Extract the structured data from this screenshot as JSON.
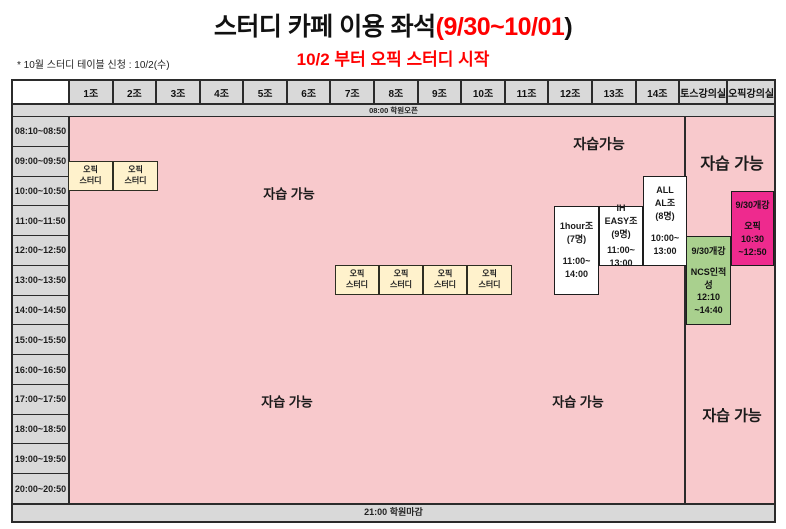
{
  "title": {
    "main": "스터디 카페 이용 좌석",
    "dates": "(9/30~10/01",
    "close_paren": ")",
    "subtitle": "10/2 부터 오픽 스터디 시작"
  },
  "note": "* 10월 스터디 테이블 신청 : 10/2(수)",
  "banners": {
    "open": "08:00 학원오픈",
    "close": "21:00 학원마감"
  },
  "columns": [
    "1조",
    "2조",
    "3조",
    "4조",
    "5조",
    "6조",
    "7조",
    "8조",
    "9조",
    "10조",
    "11조",
    "12조",
    "13조",
    "14조",
    "토스강의실",
    "오픽강의실"
  ],
  "times": [
    "08:10~08:50",
    "09:00~09:50",
    "10:00~10:50",
    "11:00~11:50",
    "12:00~12:50",
    "13:00~13:50",
    "14:00~14:50",
    "15:00~15:50",
    "16:00~16:50",
    "17:00~17:50",
    "18:00~18:50",
    "19:00~19:50",
    "20:00~20:50"
  ],
  "free_study": {
    "main_top": "자습 가능",
    "mid_top": "자습가능",
    "lecture_top": "자습 가능",
    "main_bottom": "자습 가능",
    "mid_bottom": "자습 가능",
    "lecture_bottom": "자습 가능"
  },
  "study_cells": {
    "opic_line1": "오픽",
    "opic_line2": "스터디"
  },
  "group_cells": {
    "one_hour": {
      "line1": "1hour조",
      "line2": "(7명)",
      "line3": "11:00~",
      "line4": "14:00"
    },
    "ih_easy": {
      "line1": "IH",
      "line2": "EASY조",
      "line3": "(9명)",
      "line4": "11:00~",
      "line5": "13:00"
    },
    "all_al": {
      "line1": "ALL",
      "line2": "AL조",
      "line3": "(8명)",
      "line4": "10:00~",
      "line5": "13:00"
    }
  },
  "lecture_cells": {
    "ncs": {
      "line1": "9/30개강",
      "line2": "NCS인적성",
      "line3": "12:10",
      "line4": "~14:40"
    },
    "opic": {
      "line1": "9/30개강",
      "line2": "오픽",
      "line3": "10:30",
      "line4": "~12:50"
    }
  },
  "colors": {
    "pink_bg": "#F8C9CC",
    "grey": "#D9D9D9",
    "yellow": "#FFF2CC",
    "green": "#A9D08E",
    "magenta": "#EE2A8E",
    "title_red": "#FF0000"
  }
}
